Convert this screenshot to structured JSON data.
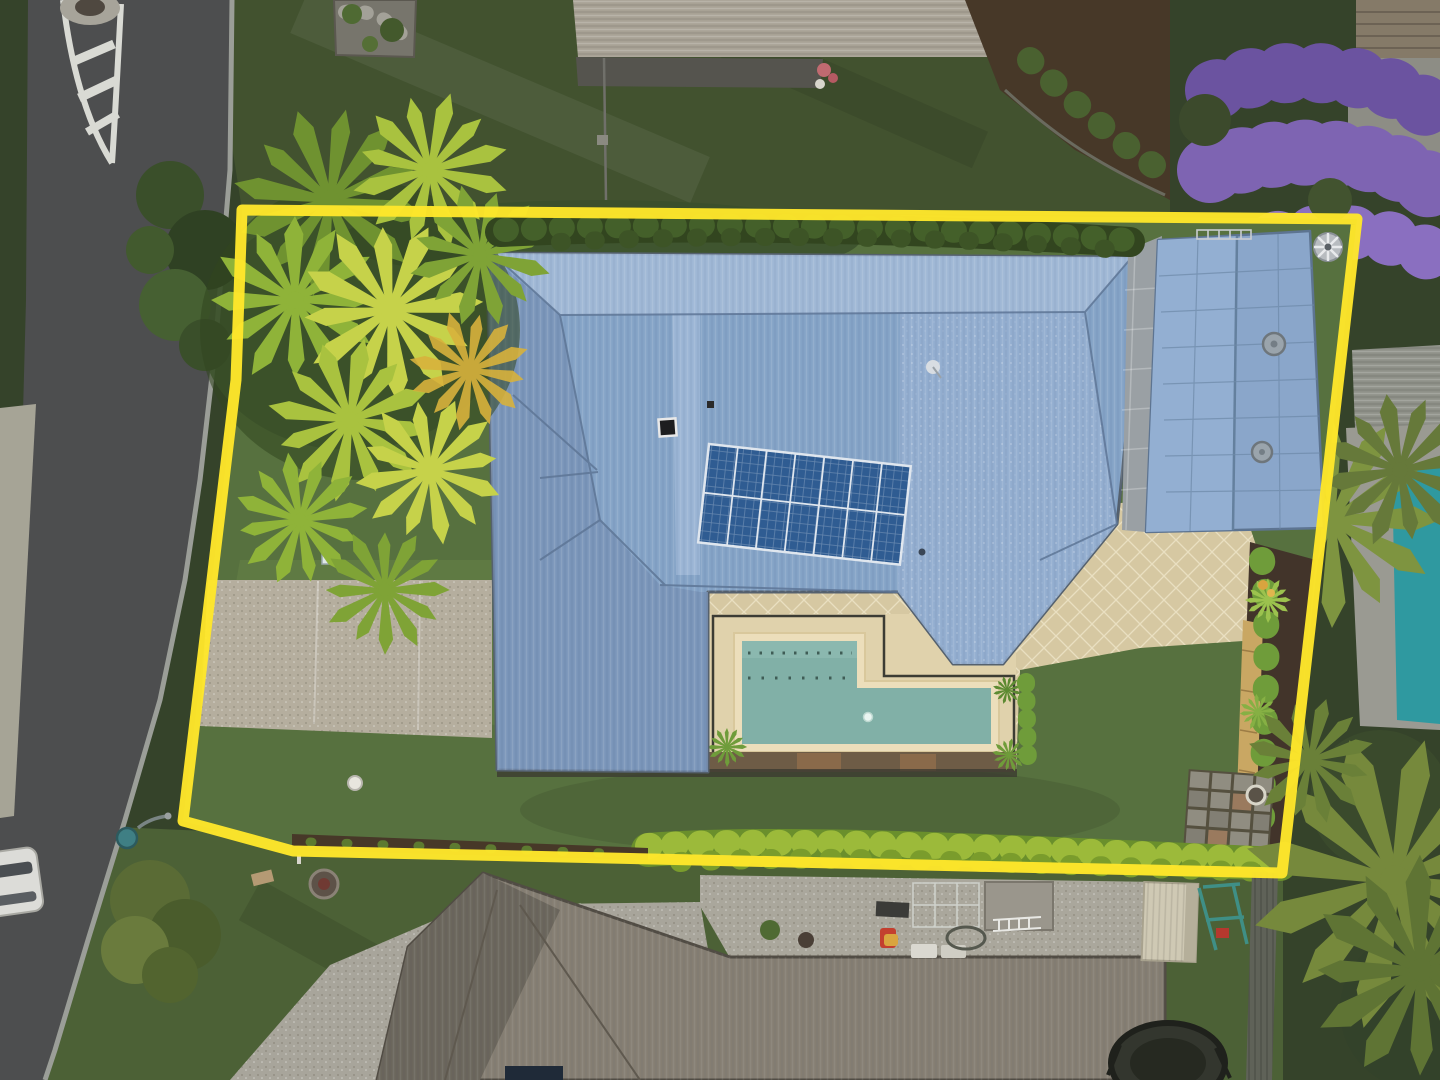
{
  "scene": {
    "type": "aerial-drone-photograph",
    "subject": "suburban residential property outlined with a yellow lot-boundary overlay",
    "time_of_day": "dusk",
    "no_visible_text": true
  },
  "boundary": {
    "shape": "quadrilateral lot outline",
    "points": "242,210 1357,219 1282,873 293,851 183,821 236,380",
    "stroke_width": 11
  },
  "features": {
    "main_house": "large hip-roofed house, pale blue corrugated metal roof, solar array, skylight, satellite dish",
    "solar_array": "14 panels, 2 rows x 7 columns, portrait orientation",
    "pool": "L-shaped in-ground pool with cream coping, dark safety fence, timber deck edge",
    "garage": "detached blue gable-roof studio/garage with two roof vents and whirlybird",
    "landscaping": "golden cane palm cluster, boundary hedges, garden beds, paver courtyard",
    "street": "curved asphalt road with painted traffic island, street light, footpath, parked car, street trees",
    "neighbors": "grey-roof houses top and bottom, jacaranda tree, neighbouring pool, shed, swing set, trampoline"
  },
  "colors": {
    "boundary_yellow": "#ffe72b",
    "roof_main": "#84a3c6",
    "roof_main_light": "#a2b9d6",
    "roof_main_shade": "#7790b4",
    "roof_line": "#5e7696",
    "roof_garage": "#8aa6ca",
    "solar_panel": "#2f5c92",
    "pool_water": "#81b0a7",
    "pool_water_light": "#90bcb2",
    "pool_coping": "#ecdebb",
    "paving_tan": "#d6c8a2",
    "paving_inner": "#e0d2ac",
    "deck_timber": "#6e5c46",
    "lawn_main": "#57713f",
    "lawn_dark": "#35432a",
    "lawn_top": "#42522f",
    "lawn_neighbor": "#4c6136",
    "hedge_bright": "#9cba3a",
    "hedge_dark": "#32451f",
    "palm_green": "#a9c23f",
    "palm_lime": "#c6d24a",
    "palm_dark": "#6f9230",
    "palm_olive": "#76893c",
    "road_asphalt": "#4d4e4f",
    "curb": "#9b9e98",
    "footpath": "#a6a496",
    "driveway": "#b5ae9e",
    "aggregate": "#a8a59b",
    "neighbor_roof_top": "#a8a295",
    "neighbor_roof_bottom": "#857e72",
    "neighbor_roof_shade": "#6b665c",
    "jacaranda": "#7e64b2",
    "neighbor_pool": "#2f99a0",
    "mulch": "#473828",
    "fence_dark": "#5f6258",
    "fence_timber": "#c9a763",
    "shed_cream": "#cfc9b4",
    "swing_teal": "#3f8f86",
    "streetlight_teal": "#3f7f84",
    "paver_grey": "#908d81",
    "marking_white": "#d9dad4"
  }
}
